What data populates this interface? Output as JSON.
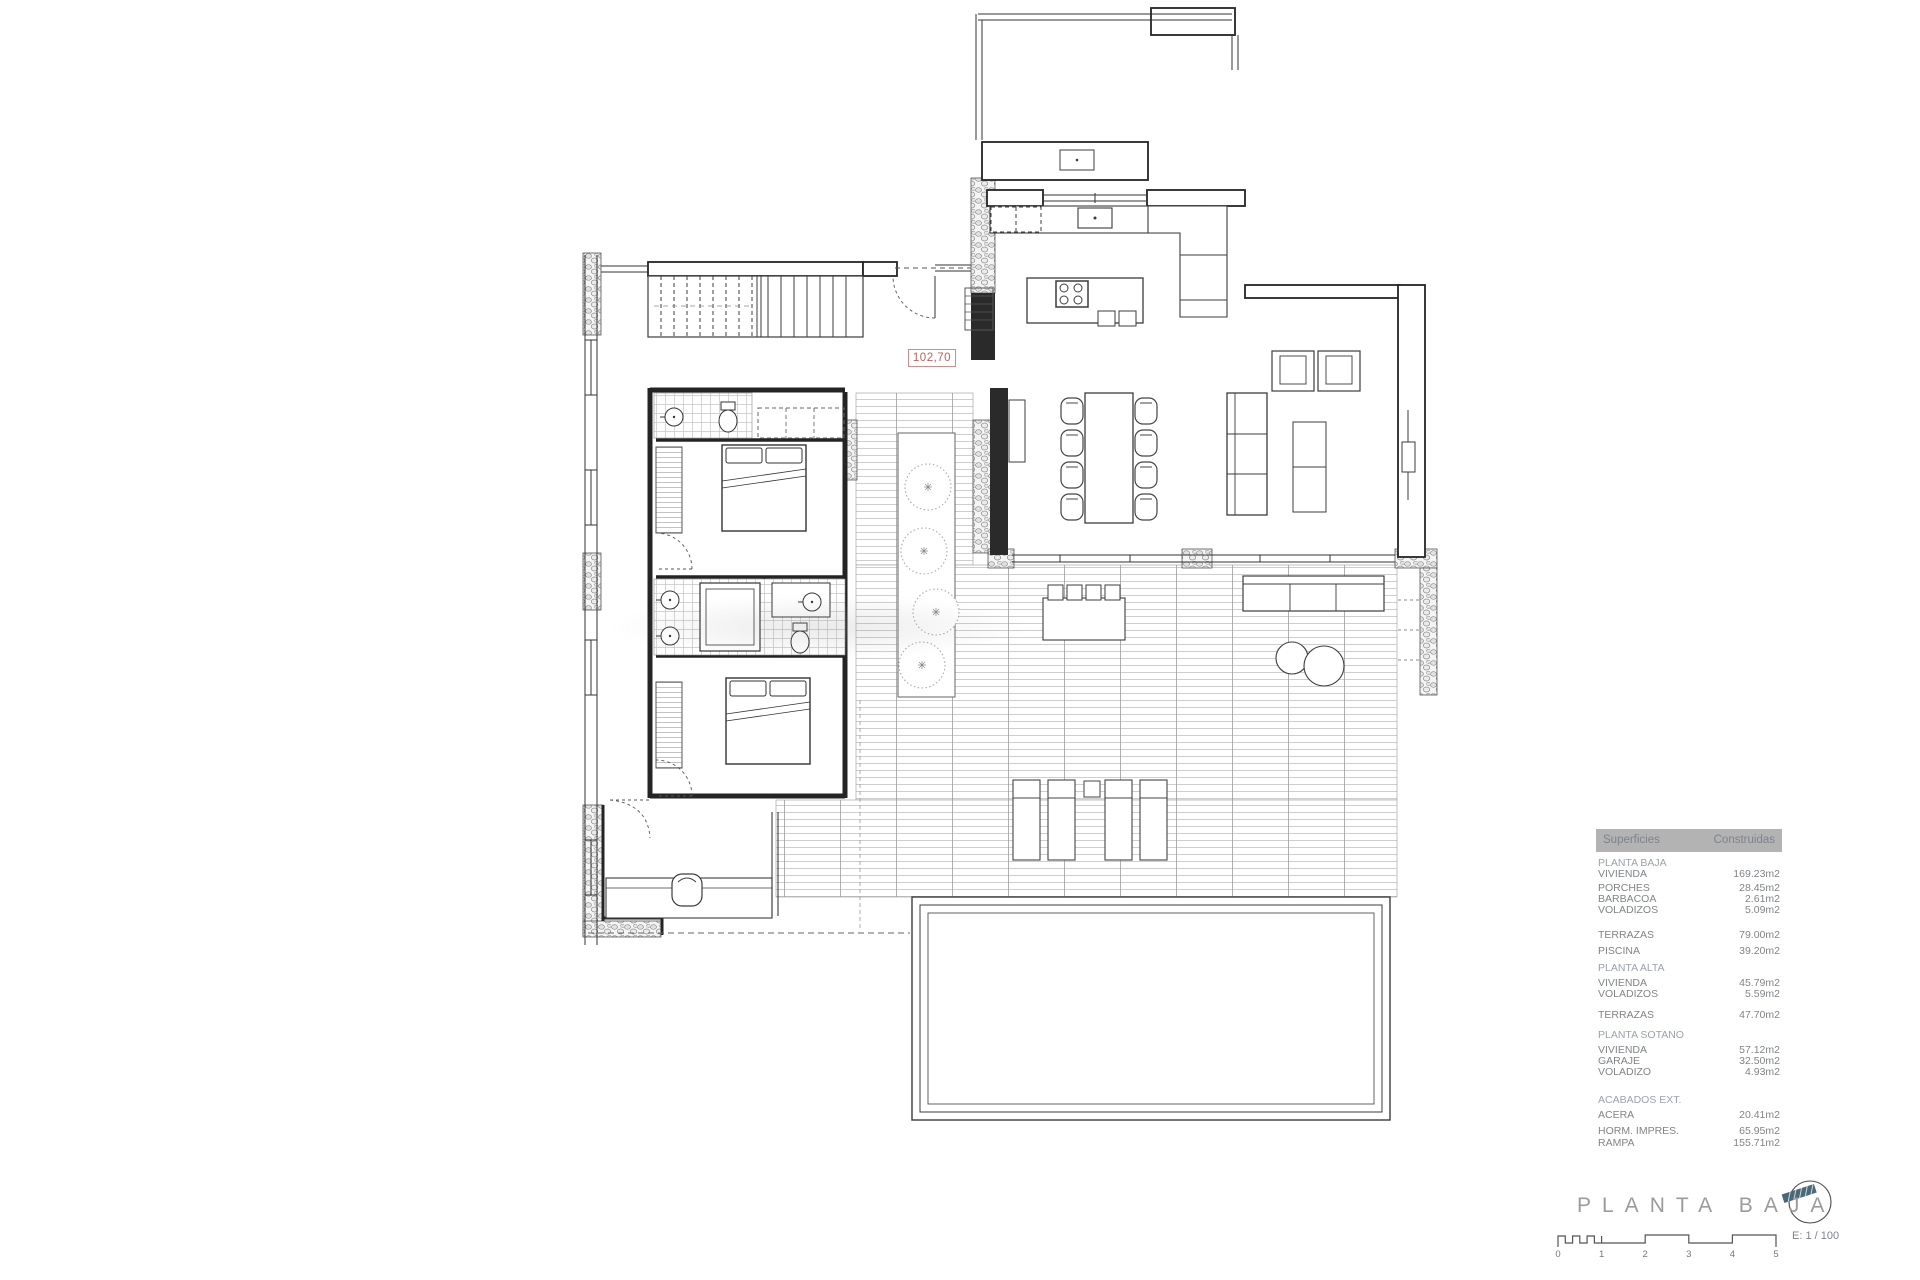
{
  "plan_labels": {
    "level": "102,70"
  },
  "surfaces_table": {
    "header": {
      "col1": "Superficies",
      "col2": "Construidas"
    },
    "rows": [
      {
        "type": "section",
        "label": "PLANTA BAJA",
        "value": ""
      },
      {
        "type": "data",
        "label": "VIVIENDA",
        "value": "169.23m2"
      },
      {
        "type": "data",
        "label": "PORCHES",
        "value": "28.45m2"
      },
      {
        "type": "data",
        "label": "BARBACOA",
        "value": "2.61m2"
      },
      {
        "type": "data",
        "label": "VOLADIZOS",
        "value": "5.09m2"
      },
      {
        "type": "data",
        "label": "TERRAZAS",
        "value": "79.00m2"
      },
      {
        "type": "data",
        "label": "PISCINA",
        "value": "39.20m2"
      },
      {
        "type": "section",
        "label": "PLANTA ALTA",
        "value": ""
      },
      {
        "type": "data",
        "label": "VIVIENDA",
        "value": "45.79m2"
      },
      {
        "type": "data",
        "label": "VOLADIZOS",
        "value": "5.59m2"
      },
      {
        "type": "data",
        "label": "TERRAZAS",
        "value": "47.70m2"
      },
      {
        "type": "section",
        "label": "PLANTA SOTANO",
        "value": ""
      },
      {
        "type": "data",
        "label": "VIVIENDA",
        "value": "57.12m2"
      },
      {
        "type": "data",
        "label": "GARAJE",
        "value": "32.50m2"
      },
      {
        "type": "data",
        "label": "VOLADIZO",
        "value": "4.93m2"
      },
      {
        "type": "section",
        "label": "ACABADOS EXT.",
        "value": ""
      },
      {
        "type": "data",
        "label": "ACERA",
        "value": "20.41m2"
      },
      {
        "type": "data",
        "label": "HORM. IMPRES.",
        "value": "65.95m2"
      },
      {
        "type": "data",
        "label": "RAMPA",
        "value": "155.71m2"
      }
    ]
  },
  "footer": {
    "title": "PLANTA BAJA",
    "scale_text": "E: 1 / 100",
    "scale_ticks": [
      "0",
      "1",
      "2",
      "3",
      "4",
      "5"
    ]
  },
  "colors": {
    "dim_red": "#b9625e",
    "table_header_bg": "#b3b3b3",
    "table_header_text": "#7d838c",
    "section_text": "#9aa2ab",
    "row_text": "#808488",
    "logo_blue": "#4a6878",
    "title_gray": "#9b9b9b"
  }
}
